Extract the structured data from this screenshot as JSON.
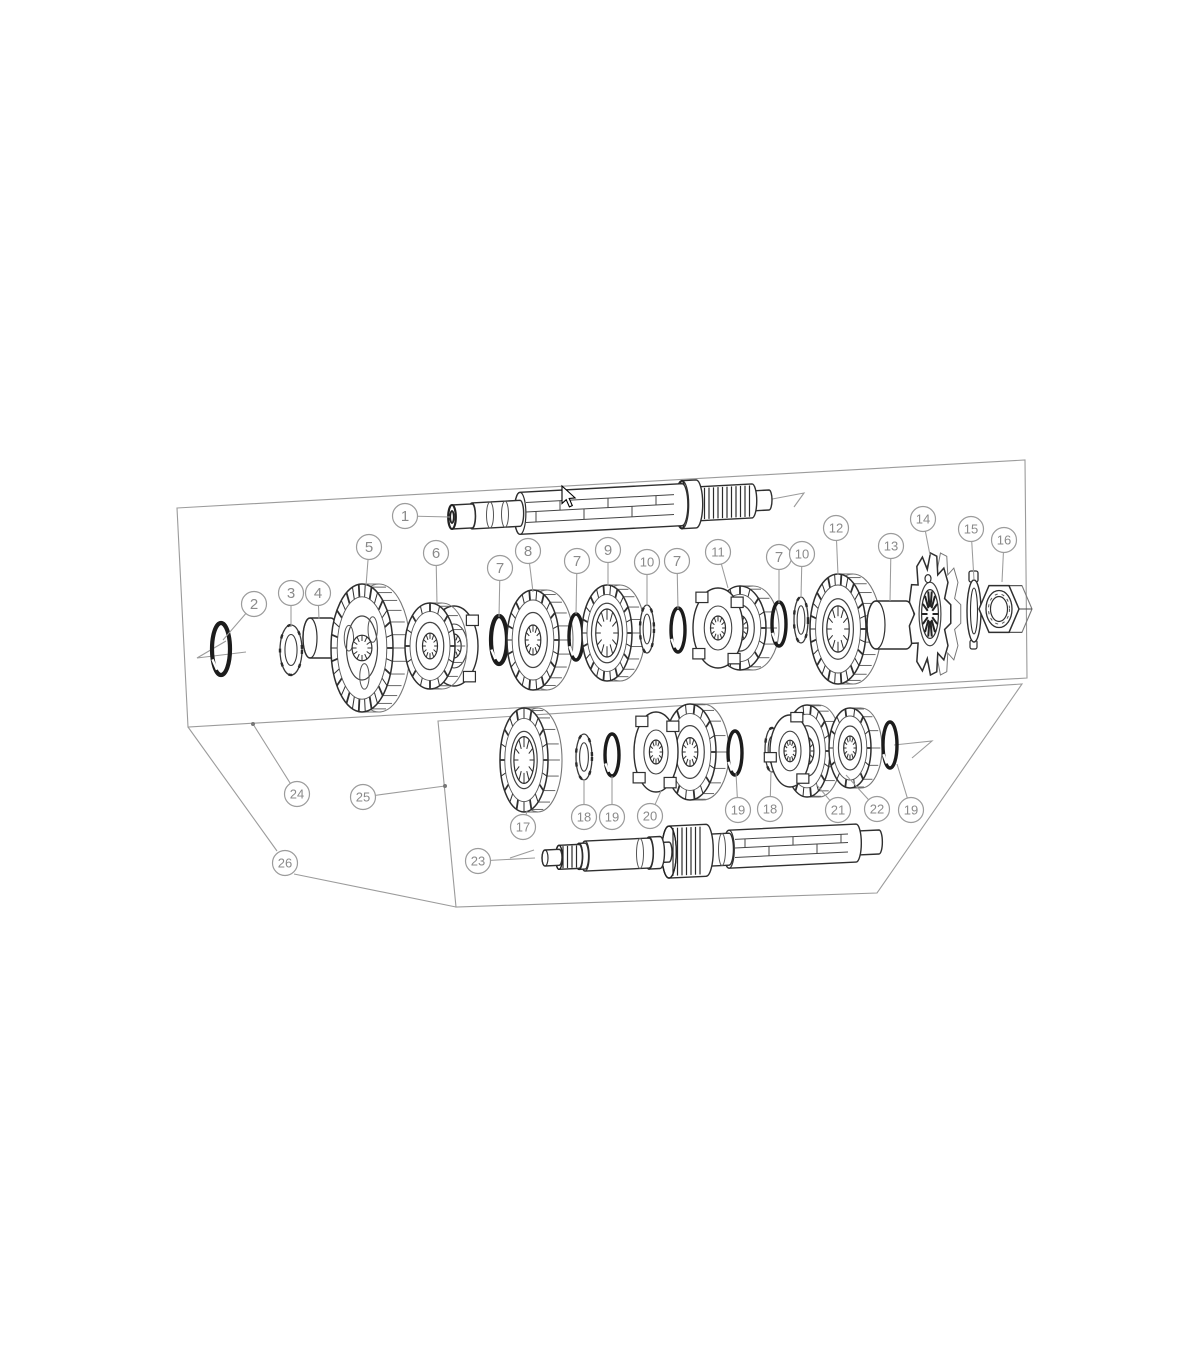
{
  "colors": {
    "background": "#ffffff",
    "line_gray": "#9b9b9b",
    "part_ink": "#2f2f2f",
    "label_gray": "#8a8a8a"
  },
  "balloons": [
    {
      "label": "1",
      "cx": 405,
      "cy": 516,
      "lx": 450,
      "ly": 517
    },
    {
      "label": "2",
      "cx": 254,
      "cy": 604,
      "lx": 223,
      "ly": 640
    },
    {
      "label": "3",
      "cx": 291,
      "cy": 593,
      "lx": 291,
      "ly": 627
    },
    {
      "label": "4",
      "cx": 318,
      "cy": 593,
      "lx": 319,
      "ly": 619
    },
    {
      "label": "5",
      "cx": 369,
      "cy": 547,
      "lx": 366,
      "ly": 586
    },
    {
      "label": "6",
      "cx": 436,
      "cy": 553,
      "lx": 437,
      "ly": 604
    },
    {
      "label": "7",
      "cx": 500,
      "cy": 568,
      "lx": 499,
      "ly": 617
    },
    {
      "label": "8",
      "cx": 528,
      "cy": 551,
      "lx": 533,
      "ly": 592
    },
    {
      "label": "7",
      "cx": 577,
      "cy": 561,
      "lx": 576,
      "ly": 614
    },
    {
      "label": "9",
      "cx": 608,
      "cy": 550,
      "lx": 608,
      "ly": 586
    },
    {
      "label": "10",
      "cx": 647,
      "cy": 562,
      "lx": 647,
      "ly": 606
    },
    {
      "label": "7",
      "cx": 677,
      "cy": 561,
      "lx": 678,
      "ly": 609
    },
    {
      "label": "11",
      "cx": 718,
      "cy": 552,
      "lx": 728,
      "ly": 588
    },
    {
      "label": "7",
      "cx": 779,
      "cy": 557,
      "lx": 779,
      "ly": 603
    },
    {
      "label": "10",
      "cx": 802,
      "cy": 554,
      "lx": 801,
      "ly": 598
    },
    {
      "label": "12",
      "cx": 836,
      "cy": 528,
      "lx": 838,
      "ly": 575
    },
    {
      "label": "13",
      "cx": 891,
      "cy": 546,
      "lx": 890,
      "ly": 601
    },
    {
      "label": "14",
      "cx": 923,
      "cy": 519,
      "lx": 930,
      "ly": 555
    },
    {
      "label": "15",
      "cx": 971,
      "cy": 529,
      "lx": 974,
      "ly": 580
    },
    {
      "label": "16",
      "cx": 1004,
      "cy": 540,
      "lx": 1002,
      "ly": 582
    },
    {
      "label": "17",
      "cx": 523,
      "cy": 827,
      "lx": 527,
      "ly": 811
    },
    {
      "label": "18",
      "cx": 584,
      "cy": 817,
      "lx": 584,
      "ly": 779
    },
    {
      "label": "19",
      "cx": 612,
      "cy": 817,
      "lx": 612,
      "ly": 776
    },
    {
      "label": "20",
      "cx": 650,
      "cy": 816,
      "lx": 661,
      "ly": 791
    },
    {
      "label": "19",
      "cx": 738,
      "cy": 810,
      "lx": 736,
      "ly": 773
    },
    {
      "label": "18",
      "cx": 770,
      "cy": 809,
      "lx": 771,
      "ly": 771
    },
    {
      "label": "21",
      "cx": 838,
      "cy": 810,
      "lx": 816,
      "ly": 784
    },
    {
      "label": "22",
      "cx": 877,
      "cy": 809,
      "lx": 846,
      "ly": 775
    },
    {
      "label": "19",
      "cx": 911,
      "cy": 810,
      "lx": 897,
      "ly": 764
    },
    {
      "label": "23",
      "cx": 478,
      "cy": 861,
      "lx": 535,
      "ly": 858
    },
    {
      "label": "24",
      "cx": 297,
      "cy": 794,
      "lx": 253,
      "ly": 724,
      "dot": true
    },
    {
      "label": "25",
      "cx": 363,
      "cy": 797,
      "lx": 445,
      "ly": 786,
      "dot": true
    },
    {
      "label": "26",
      "cx": 285,
      "cy": 863
    }
  ]
}
